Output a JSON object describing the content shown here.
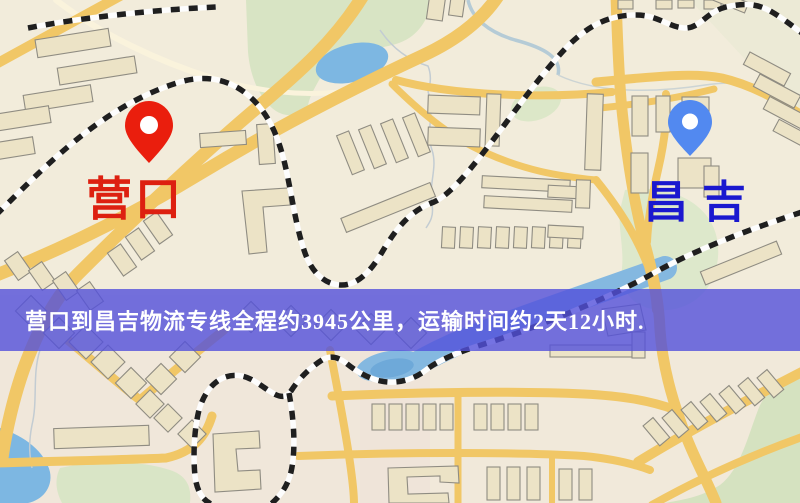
{
  "origin": {
    "label": "营口",
    "pin_color": "#ea1e0d",
    "label_color": "#dd2010"
  },
  "destination": {
    "label": "昌吉",
    "pin_color": "#5289f0",
    "label_color": "#1a18cf"
  },
  "banner": {
    "text": "营口到昌吉物流专线全程约3945公里，运输时间约2天12小时.",
    "distance_km": "3945",
    "duration": "2天12小时",
    "background": "#5250db",
    "text_color": "#ffffff"
  },
  "map_colors": {
    "background": "#f2ecdb",
    "road": "#f1c766",
    "building": "#ece3c6",
    "green_area": "#d8e4c4",
    "water": "#7db7e2",
    "railway": "#1f1f1f"
  }
}
